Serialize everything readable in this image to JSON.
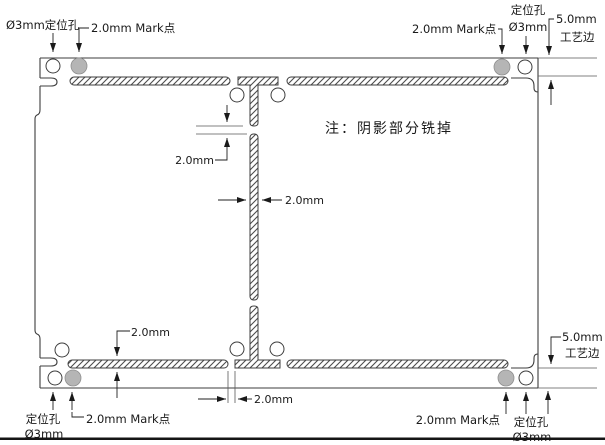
{
  "diagram": {
    "note": "注：阴影部分铣掉",
    "annotations": {
      "top_left": {
        "hole_label": "Ø3mm定位孔",
        "mark_label": "2.0mm Mark点"
      },
      "top_right": {
        "mark_label": "2.0mm Mark点",
        "hole_label_line1": "定位孔",
        "hole_label_line2": "Ø3mm",
        "edge_label_line1": "5.0mm",
        "edge_label_line2": "工艺边"
      },
      "bottom_left": {
        "hole_label_line1": "定位孔",
        "hole_label_line2": "Ø3mm",
        "mark_label": "2.0mm Mark点"
      },
      "bottom_right": {
        "mark_label": "2.0mm Mark点",
        "hole_label_line1": "定位孔",
        "hole_label_line2": "Ø3mm",
        "edge_label_line1": "5.0mm",
        "edge_label_line2": "工艺边"
      },
      "dimensions": {
        "center_tab_gap": "2.0mm",
        "center_slot_width": "2.0mm",
        "bottom_slot_height": "2.0mm",
        "bottom_tab_width": "2.0mm"
      }
    },
    "colors": {
      "mark_point_fill": "#b5b5b5",
      "mark_point_stroke": "#8f8f8f",
      "note_text": "#8f959b",
      "line": "#3d3d3d"
    }
  }
}
